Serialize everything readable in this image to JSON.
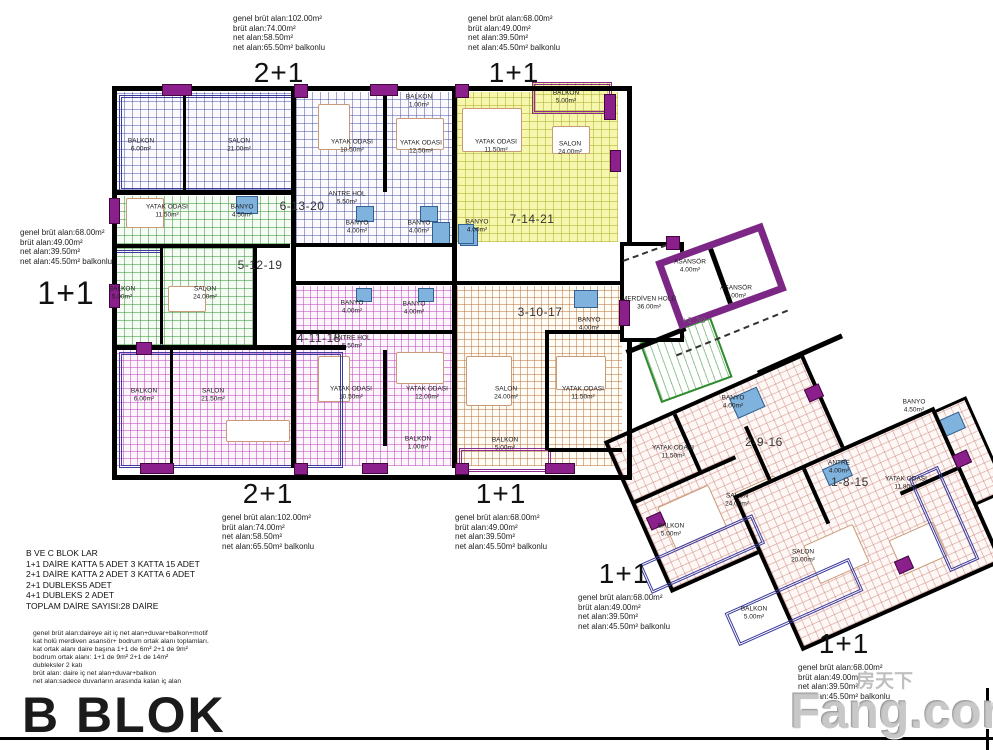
{
  "title": "B BLOK",
  "watermark": {
    "brand": "Fang.com",
    "cjk": "房天下"
  },
  "level_marker": "+1.30",
  "colors": {
    "wall": "#000000",
    "window_accent": "#8b1f8b",
    "core_border": "#7c2786",
    "blue_grid": "#4650a5",
    "green_grid": "#3a9e3a",
    "yellow_fill": "#f6f6ac",
    "magenta_grid": "#b93cb9",
    "orange_grid": "#b46e37",
    "pink_grid": "#c8736a",
    "fixture_blue": "#7fb2dd"
  },
  "info_blocks": [
    {
      "id": "ib0",
      "type": "2+1",
      "type_top": false,
      "lines": [
        "genel brüt alan:102.00m²",
        "brüt alan:74.00m²",
        "net alan:58.50m²",
        "net alan:65.50m² balkonlu"
      ]
    },
    {
      "id": "ib1",
      "type": "1+1",
      "type_top": false,
      "lines": [
        "genel brüt alan:68.00m²",
        "brüt alan:49.00m²",
        "net alan:39.50m²",
        "net alan:45.50m² balkonlu"
      ]
    },
    {
      "id": "ib2",
      "type": "1+1",
      "type_top": false,
      "lines": [
        "genel brüt alan:68.00m²",
        "brüt alan:49.00m²",
        "net alan:39.50m²",
        "net alan:45.50m² balkonlu"
      ]
    },
    {
      "id": "ib3",
      "type": "2+1",
      "type_top": true,
      "lines": [
        "genel brüt alan:102.00m²",
        "brüt alan:74.00m²",
        "net alan:58.50m²",
        "net alan:65.50m² balkonlu"
      ]
    },
    {
      "id": "ib4",
      "type": "1+1",
      "type_top": true,
      "lines": [
        "genel brüt alan:68.00m²",
        "brüt alan:49.00m²",
        "net alan:39.50m²",
        "net alan:45.50m² balkonlu"
      ]
    },
    {
      "id": "ib5",
      "type": "1+1",
      "type_top": true,
      "lines": [
        "genel brüt alan:68.00m²",
        "brüt alan:49.00m²",
        "net alan:39.50m²",
        "net alan:45.50m² balkonlu"
      ]
    },
    {
      "id": "ib6",
      "type": "1+1",
      "type_top": true,
      "lines": [
        "genel brüt alan:68.00m²",
        "brüt alan:49.00m²",
        "net alan:39.50m²",
        "net alan:45.50m² balkonlu"
      ]
    }
  ],
  "summary": {
    "lines": [
      "B VE C BLOK LAR",
      "1+1 DAİRE KATTA 5 ADET  3 KATTA 15 ADET",
      "2+1 DAİRE KATTA 2 ADET 3 KATTA 6 ADET",
      "2+1 DUBLEKS5 ADET",
      "4+1 DUBLEKS 2 ADET",
      "TOPLAM DAİRE SAYISI:28 DAİRE"
    ]
  },
  "notes": {
    "lines": [
      "genel brüt alan:daireye ait iç net alan+duvar+balkon+motif",
      "kat holü merdiven asansör+ bodrum ortak alanı toplamları.",
      "kat ortak alanı daire başına 1+1 de 6m² 2+1 de 9m²",
      "bodrum ortak alanı: 1+1 de 9m² 2+1 de 14m²",
      "dubleksler 2 katı",
      "brüt alan: daire iç net alan+duvar+balkon",
      "net alan:sadece duvarların arasında kalan iç alan"
    ]
  },
  "unit_labels": [
    {
      "t": "6-13-20",
      "x": 302,
      "y": 206
    },
    {
      "t": "7-14-21",
      "x": 532,
      "y": 219
    },
    {
      "t": "5-12-19",
      "x": 260,
      "y": 265
    },
    {
      "t": "4-11-18",
      "x": 319,
      "y": 338
    },
    {
      "t": "3-10-17",
      "x": 540,
      "y": 312
    },
    {
      "t": "2-9-16",
      "x": 764,
      "y": 442
    },
    {
      "t": "1-8-15",
      "x": 850,
      "y": 482
    },
    {
      "t": "+1.30",
      "x": 694,
      "y": 320,
      "cls": "small"
    }
  ],
  "rooms": [
    {
      "n": "BALKON",
      "a": "6.00m²",
      "x": 141,
      "y": 145
    },
    {
      "n": "SALON",
      "a": "21.00m²",
      "x": 239,
      "y": 145
    },
    {
      "n": "BALKON",
      "a": "1.00m²",
      "x": 419,
      "y": 101
    },
    {
      "n": "YATAK ODASI",
      "a": "10.50m²",
      "x": 352,
      "y": 146
    },
    {
      "n": "YATAK ODASI",
      "a": "12.50m²",
      "x": 421,
      "y": 147
    },
    {
      "n": "ANTRE HOL",
      "a": "5.50m²",
      "x": 347,
      "y": 198
    },
    {
      "n": "BANYO",
      "a": "4.00m²",
      "x": 357,
      "y": 227
    },
    {
      "n": "BANYO",
      "a": "4.00m²",
      "x": 419,
      "y": 227
    },
    {
      "n": "BALKON",
      "a": "5.00m²",
      "x": 566,
      "y": 97
    },
    {
      "n": "YATAK ODASI",
      "a": "11.50m²",
      "x": 496,
      "y": 146
    },
    {
      "n": "SALON",
      "a": "24.00m²",
      "x": 570,
      "y": 148
    },
    {
      "n": "BANYO",
      "a": "4.00m²",
      "x": 477,
      "y": 226
    },
    {
      "n": "YATAK ODASI",
      "a": "11.50m²",
      "x": 167,
      "y": 211
    },
    {
      "n": "BANYO",
      "a": "4.50m²",
      "x": 242,
      "y": 211
    },
    {
      "n": "BALKON",
      "a": "5.00m²",
      "x": 122,
      "y": 293
    },
    {
      "n": "SALON",
      "a": "24.00m²",
      "x": 205,
      "y": 293
    },
    {
      "n": "BANYO",
      "a": "4.00m²",
      "x": 352,
      "y": 307
    },
    {
      "n": "BANYO",
      "a": "4.00m²",
      "x": 414,
      "y": 308
    },
    {
      "n": "ANTRE HOL",
      "a": "5.50m²",
      "x": 352,
      "y": 342
    },
    {
      "n": "YATAK ODASI",
      "a": "10.50m²",
      "x": 351,
      "y": 393
    },
    {
      "n": "YATAK ODASI",
      "a": "12.00m²",
      "x": 427,
      "y": 393
    },
    {
      "n": "BALKON",
      "a": "1.00m²",
      "x": 418,
      "y": 443
    },
    {
      "n": "BALKON",
      "a": "6.00m²",
      "x": 144,
      "y": 395
    },
    {
      "n": "SALON",
      "a": "21.50m²",
      "x": 213,
      "y": 395
    },
    {
      "n": "BANYO",
      "a": "4.00m²",
      "x": 589,
      "y": 324
    },
    {
      "n": "SALON",
      "a": "24.00m²",
      "x": 506,
      "y": 393
    },
    {
      "n": "YATAK ODASI",
      "a": "11.50m²",
      "x": 583,
      "y": 393
    },
    {
      "n": "BALKON",
      "a": "5.00m²",
      "x": 505,
      "y": 444
    },
    {
      "n": "MERDİVEN HOLÜ",
      "a": "36.00m²",
      "x": 649,
      "y": 303
    },
    {
      "n": "ASANSÖR",
      "a": "4.00m²",
      "x": 690,
      "y": 266
    },
    {
      "n": "ASANSÖR",
      "a": "4.00m²",
      "x": 736,
      "y": 292
    },
    {
      "n": "BANYO",
      "a": "4.00m²",
      "x": 733,
      "y": 402
    },
    {
      "n": "YATAK ODASI",
      "a": "11.50m²",
      "x": 673,
      "y": 452
    },
    {
      "n": "SALON",
      "a": "24.00m²",
      "x": 737,
      "y": 500
    },
    {
      "n": "BALKON",
      "a": "5.00m²",
      "x": 671,
      "y": 530
    },
    {
      "n": "ANTRE",
      "a": "4.00m²",
      "x": 839,
      "y": 467
    },
    {
      "n": "BANYO",
      "a": "4.50m²",
      "x": 914,
      "y": 406
    },
    {
      "n": "YATAK ODASI",
      "a": "11.80m²",
      "x": 906,
      "y": 483
    },
    {
      "n": "SALON",
      "a": "20.00m²",
      "x": 803,
      "y": 556
    },
    {
      "n": "BALKON",
      "a": "5.00m²",
      "x": 754,
      "y": 613
    }
  ]
}
